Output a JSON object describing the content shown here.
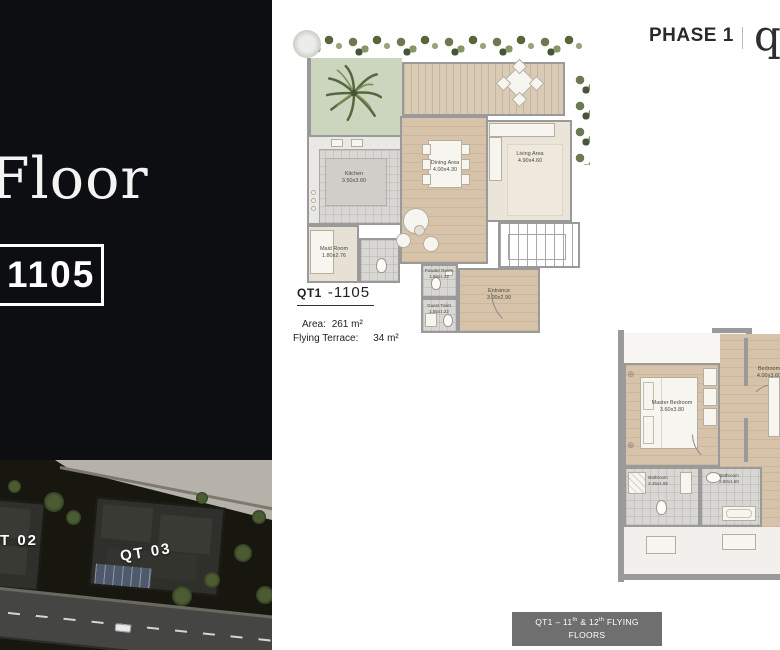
{
  "left_panel": {
    "title_fragment": "Floor",
    "unit_number": "1105"
  },
  "site_map": {
    "labels": {
      "qt02": "T 02",
      "qt03": "QT 03"
    }
  },
  "header": {
    "phase": "PHASE 1",
    "logo_fragment": "q"
  },
  "plan1": {
    "unit_code": "QT1",
    "unit_suffix": "-1105",
    "area_label": "Area:",
    "area_value": "261 m²",
    "terrace_label": "Flying Terrace:",
    "terrace_value": "34 m²",
    "rooms": {
      "kitchen": {
        "name": "Kitchen",
        "dims": "3.50x3.60"
      },
      "dining": {
        "name": "Dining Area",
        "dims": "4.00x4.30"
      },
      "living": {
        "name": "Living Area",
        "dims": "4.90x4.60"
      },
      "maid": {
        "name": "Maid Room",
        "dims": "1.80x2.76"
      },
      "powder": {
        "name": "Powder Room",
        "dims": "1.55x1.22"
      },
      "guest_toilet": {
        "name": "Guest Toilet",
        "dims": "1.55x1.22"
      },
      "entrance": {
        "name": "Entrance",
        "dims": "3.00x2.90"
      }
    }
  },
  "plan2": {
    "rooms": {
      "master": {
        "name": "Master Bedroom",
        "dims": "3.60x3.80"
      },
      "bedroom": {
        "name": "Bedroom",
        "dims": "4.00x3.60"
      },
      "bathroom1": {
        "name": "Bathroom",
        "dims": "2.45x1.65"
      },
      "bathroom2": {
        "name": "Bathroom",
        "dims": "2.60x1.60"
      }
    }
  },
  "caption": {
    "line1_parts": [
      "QT1 – 11",
      "th",
      " & 12",
      "th",
      " FLYING"
    ],
    "line2": "FLOORS"
  },
  "colors": {
    "panel_bg": "#0c0e11",
    "caption_bg": "#6f6f6f",
    "wall": "#9a9a9a",
    "garden": "#ccd5bd",
    "deck_wood": "#d9cbb5",
    "interior_wood": "#d7c3aa",
    "phase_text": "#2a2a2a"
  }
}
